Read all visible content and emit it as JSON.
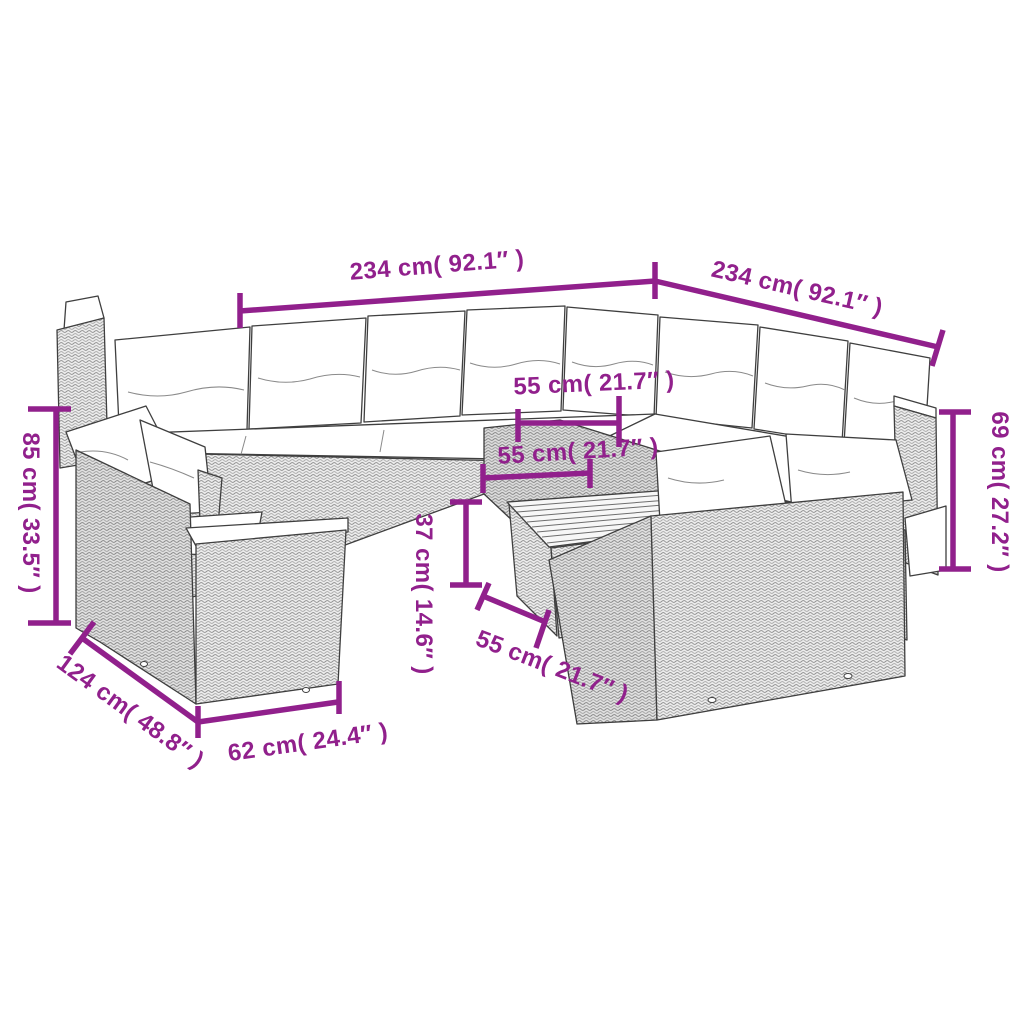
{
  "background_color": "#ffffff",
  "accent_color": "#91208C",
  "illustration": "rattan-garden-sofa-set-line-drawing",
  "labels": {
    "width_left": "234 cm( 92.1″ )",
    "width_right": "234 cm( 92.1″ )",
    "back_height": "69 cm( 27.2″ )",
    "sofa_height": "85 cm( 33.5″ )",
    "seat_back_width": "55 cm( 21.7″ )",
    "seat_mid_width": "55 cm( 21.7″ )",
    "table_height": "37 cm( 14.6″ )",
    "seat_front_width": "55 cm( 21.7″ )",
    "sofa_depth": "124 cm( 48.8″ )",
    "seat_depth": "62 cm( 24.4″ )"
  }
}
